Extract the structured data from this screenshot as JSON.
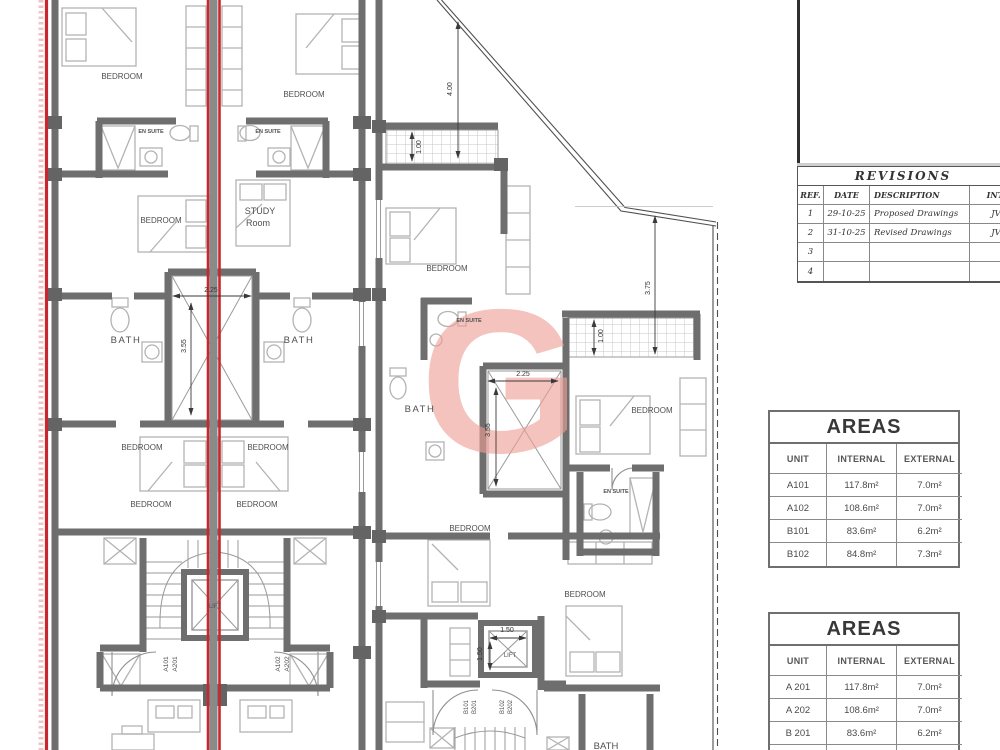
{
  "watermark": {
    "letter": "G",
    "color": "#ee9f96"
  },
  "palette": {
    "wall": "#6e6e6e",
    "section_line": "#c8282d",
    "furniture": "#b3b3b3"
  },
  "revisions": {
    "title": "REVISIONS",
    "headers": [
      "REF.",
      "DATE",
      "DESCRIPTION",
      "INT."
    ],
    "rows": [
      [
        "1",
        "29-10-25",
        "Proposed Drawings",
        "JV"
      ],
      [
        "2",
        "31-10-25",
        "Revised Drawings",
        "JV"
      ],
      [
        "3",
        "",
        "",
        ""
      ],
      [
        "4",
        "",
        "",
        ""
      ]
    ]
  },
  "areas_first_floor": {
    "title": "AREAS",
    "headers": [
      "UNIT",
      "INTERNAL",
      "EXTERNAL"
    ],
    "rows": [
      [
        "A101",
        "117.8m²",
        "7.0m²"
      ],
      [
        "A102",
        "108.6m²",
        "7.0m²"
      ],
      [
        "B101",
        "83.6m²",
        "6.2m²"
      ],
      [
        "B102",
        "84.8m²",
        "7.3m²"
      ]
    ]
  },
  "areas_second_floor": {
    "title": "AREAS",
    "headers": [
      "UNIT",
      "INTERNAL",
      "EXTERNAL"
    ],
    "rows": [
      [
        "A 201",
        "117.8m²",
        "7.0m²"
      ],
      [
        "A 202",
        "108.6m²",
        "7.0m²"
      ],
      [
        "B 201",
        "83.6m²",
        "6.2m²"
      ],
      [
        "B 202",
        "84.8m²",
        "7.3m²"
      ]
    ]
  },
  "plan": {
    "room_labels": [
      {
        "t": "BEDROOM",
        "x": 122,
        "y": 79
      },
      {
        "t": "BEDROOM",
        "x": 304,
        "y": 97
      },
      {
        "t": "EN SUITE",
        "x": 151,
        "y": 133,
        "s": 5.5,
        "b": 1
      },
      {
        "t": "EN SUITE",
        "x": 268,
        "y": 133,
        "s": 5.5,
        "b": 1
      },
      {
        "t": "BEDROOM",
        "x": 161,
        "y": 223
      },
      {
        "t": "STUDY",
        "x": 260,
        "y": 214,
        "s": 9
      },
      {
        "t": "Room",
        "x": 258,
        "y": 226,
        "s": 9
      },
      {
        "t": "BATH",
        "x": 126,
        "y": 343,
        "s": 9.5,
        "ls": 1.5
      },
      {
        "t": "BATH",
        "x": 299,
        "y": 343,
        "s": 9.5,
        "ls": 1.5
      },
      {
        "t": "BEDROOM",
        "x": 142,
        "y": 450
      },
      {
        "t": "BEDROOM",
        "x": 268,
        "y": 450
      },
      {
        "t": "BEDROOM",
        "x": 151,
        "y": 507
      },
      {
        "t": "BEDROOM",
        "x": 257,
        "y": 507
      },
      {
        "t": "LIFT",
        "x": 215,
        "y": 608,
        "s": 6
      },
      {
        "t": "A101",
        "x": 168,
        "y": 664,
        "s": 6.5,
        "r": -90,
        "n": "unit-label"
      },
      {
        "t": "A201",
        "x": 177,
        "y": 664,
        "s": 6.5,
        "r": -90,
        "n": "unit-label"
      },
      {
        "t": "A102",
        "x": 280,
        "y": 664,
        "s": 6.5,
        "r": -90,
        "n": "unit-label"
      },
      {
        "t": "A202",
        "x": 289,
        "y": 664,
        "s": 6.5,
        "r": -90,
        "n": "unit-label"
      },
      {
        "t": "BEDROOM",
        "x": 447,
        "y": 271
      },
      {
        "t": "EN SUITE",
        "x": 469,
        "y": 322,
        "s": 5.5,
        "b": 1
      },
      {
        "t": "BATH",
        "x": 420,
        "y": 412,
        "s": 9.5,
        "ls": 1.5
      },
      {
        "t": "BEDROOM",
        "x": 652,
        "y": 413
      },
      {
        "t": "EN SUITE",
        "x": 616,
        "y": 493,
        "s": 5.5,
        "b": 1
      },
      {
        "t": "BEDROOM",
        "x": 470,
        "y": 531
      },
      {
        "t": "BEDROOM",
        "x": 585,
        "y": 597
      },
      {
        "t": "LIFT",
        "x": 510,
        "y": 657,
        "s": 6
      },
      {
        "t": "B101",
        "x": 468,
        "y": 707,
        "s": 6,
        "r": -90,
        "n": "unit-label"
      },
      {
        "t": "B201",
        "x": 476,
        "y": 707,
        "s": 6,
        "r": -90,
        "n": "unit-label"
      },
      {
        "t": "B102",
        "x": 504,
        "y": 707,
        "s": 6,
        "r": -90,
        "n": "unit-label"
      },
      {
        "t": "B202",
        "x": 512,
        "y": 707,
        "s": 6,
        "r": -90,
        "n": "unit-label"
      },
      {
        "t": "BATH",
        "x": 606,
        "y": 749,
        "s": 9.5
      }
    ],
    "dim_labels": [
      {
        "t": "2.25",
        "x": 211,
        "y": 292
      },
      {
        "t": "3.55",
        "x": 186,
        "y": 346,
        "r": -90
      },
      {
        "t": "4.00",
        "x": 452,
        "y": 89,
        "r": -90
      },
      {
        "t": "1.00",
        "x": 421,
        "y": 147,
        "r": -90
      },
      {
        "t": "2.25",
        "x": 523,
        "y": 376
      },
      {
        "t": "3.55",
        "x": 490,
        "y": 430,
        "r": -90
      },
      {
        "t": "1.00",
        "x": 603,
        "y": 336,
        "r": -90
      },
      {
        "t": "3.75",
        "x": 650,
        "y": 288,
        "r": -90
      },
      {
        "t": "1.50",
        "x": 507,
        "y": 632
      },
      {
        "t": "1.50",
        "x": 482,
        "y": 654,
        "r": -90
      }
    ]
  }
}
